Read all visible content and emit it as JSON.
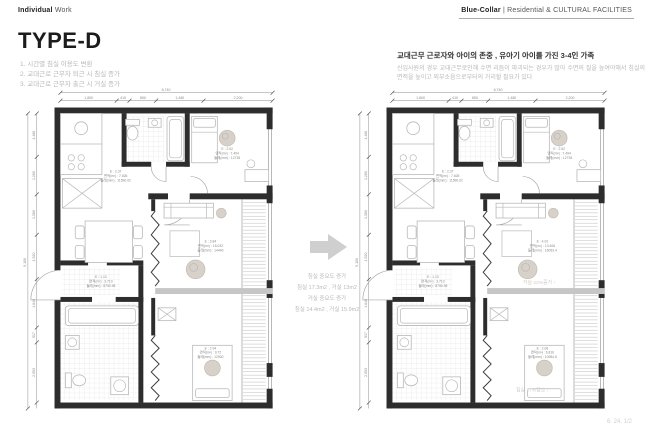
{
  "header": {
    "left_bold": "Individual",
    "left_rest": " Work",
    "right_bold": "Blue-Collar",
    "right_rest": " | Residential & CULTURAL FACILITIES"
  },
  "title": "TYPE-D",
  "notes": [
    "1. 시간별 침실 이용도 변환",
    "2. 교대근로 근무자 퇴근 시 침실 증가",
    "3. 교대근로 근무자 출근 시 거실 증가"
  ],
  "description": {
    "heading": "교대근무 근로자와 아이의 존중 , 유아기 아이를 가진 3-4인 가족",
    "body": "신입사원의 경우 교대근무로인해 수면 리듬이 파괴되는 경우가 많아 수면의 질을 높여야해서 침실의 면적을 높이고 외부소음으로부터의 거리할 필요가 있다"
  },
  "dimensions": {
    "top_total": "6,740",
    "top_segments": [
      "1,800",
      "410",
      "850",
      "1,480",
      "2,200"
    ],
    "left_total": "9,100",
    "left_segments": [
      "1,480",
      "1,280",
      "1,380",
      "1,520",
      "1,640",
      "517",
      "2,053"
    ]
  },
  "plans": [
    {
      "name": "plan-before",
      "rooms": {
        "kitchen": [
          "E : 2.37",
          "면적(m²) : 7.826",
          "둘레(mm) : 11590.02"
        ],
        "bedroom_top": [
          "E : 2.52",
          "면적(m²) : 7.494",
          "둘레(mm) : 12735"
        ],
        "living": [
          "E : 3.84",
          "면적(m²) : 15.032",
          "둘레(mm) : 14440"
        ],
        "entry": [
          "E : 1.13",
          "면적(m²) : 3.710",
          "둘레(mm) : 8790.98"
        ],
        "bedroom_bottom": [
          "E : 2.94",
          "면적(m²) : 9.72",
          "둘레(mm) : 12900"
        ]
      }
    },
    {
      "name": "plan-after",
      "rooms": {
        "kitchen": [
          "E : 2.37",
          "면적(m²) : 7.826",
          "둘레(mm) : 11590.02"
        ],
        "bedroom_top": [
          "E : 2.52",
          "면적(m²) : 7.494",
          "둘레(mm) : 12735"
        ],
        "living": [
          "E : 4.02",
          "면적(m²) : 13.406",
          "둘레(mm) : 16053.4"
        ],
        "entry": [
          "E : 1.13",
          "면적(m²) : 3.710",
          "둘레(mm) : 8790.98"
        ],
        "bedroom_bottom": [
          "E : 2.08",
          "면적(m²) : 6.816",
          "둘레(mm) : 10984.8"
        ]
      },
      "overlays": {
        "living": "거실 22%증가 ↑",
        "bedroom": "침실 17%감소 ↓"
      }
    }
  ],
  "transition": {
    "lines": [
      "침실 중요도 증가",
      "침실 17.3m2 , 거실 13m2",
      "거실 중요도 증가",
      "침실 14.4m2 , 거실 15.9m2"
    ]
  },
  "footer": "6. 24. 1/2"
}
